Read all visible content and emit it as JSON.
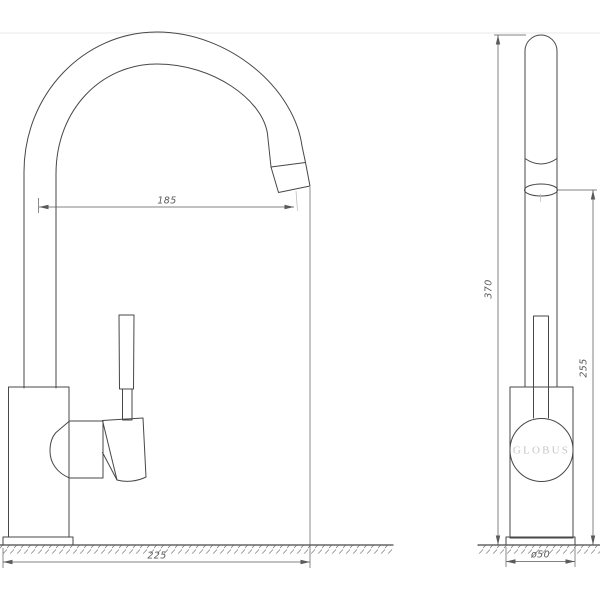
{
  "drawing": {
    "brand": "GLOBUS",
    "views": {
      "side": {
        "name": "side view of single-lever kitchen faucet",
        "dimensions": {
          "spout_reach": "185",
          "total_depth": "225"
        }
      },
      "front": {
        "name": "front view of single-lever kitchen faucet",
        "dimensions": {
          "total_height": "370",
          "outlet_height": "255",
          "base_diameter": "ø50"
        }
      }
    },
    "colors": {
      "line": "#474747",
      "dimension": "#5a5a5a",
      "brand_text": "#c7c7c7",
      "background": "#ffffff",
      "separator": "#ededed"
    }
  }
}
